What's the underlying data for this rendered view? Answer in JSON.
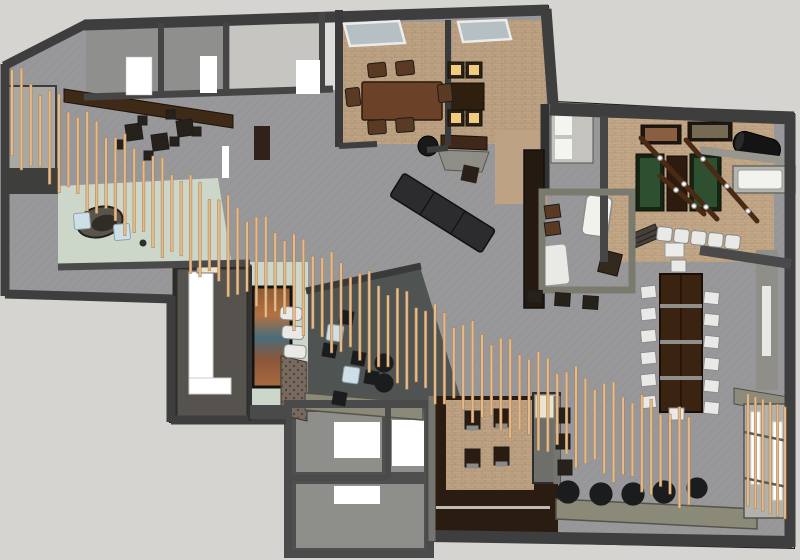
{
  "palette": {
    "outside": "#d5d4d0",
    "outline": "#1c1c1c",
    "wallDark": "#3e3e3e",
    "wallMid": "#4f4f4f",
    "wallLight": "#77766f",
    "wallOlive": "#7b7a6e",
    "carpetGray": "#98989a",
    "carpetPattern": "#888890",
    "carpetDark": "#4f5452",
    "roomGray": "#8f8f8d",
    "floorLight": "#c6c5c1",
    "tanFloor": "#bda284",
    "tanFloor2": "#c3a888",
    "brickLine": "#8a6a4a",
    "mint": "#ccd6c9",
    "woodDark": "#2a1c11",
    "woodMed": "#3f2a18",
    "woodTable": "#6b4227",
    "woodBeam": "#4a2a15",
    "slat": "#e6bb8c",
    "slatEdge": "#a97f4e",
    "green": "#2f5030",
    "glow": "#f2cb80",
    "glowFrame": "#2a2318",
    "white": "#ffffff",
    "chairWhite": "#e9e9e7",
    "chairEdge": "#8a8a88",
    "chairBrown": "#5a3a22",
    "poufBlack": "#1b1c1e",
    "furnDark": "#26211b",
    "sofaDark": "#2c2c2e",
    "blueGlass": "#b6bfc4",
    "blueTable": "#cfdfe7",
    "blueEdge": "#8fa3ad",
    "olive": "#8b8977",
    "cream": "#ece4cc",
    "stone": "#786a5e",
    "radiator": "#b4b3ac",
    "muralOrange": "#b5713f",
    "muralBlue": "#4a6d7c"
  },
  "scene": {
    "slat_screen": {
      "x_start": 12,
      "x_end": 698,
      "spacing": 9.4,
      "width": 2.6,
      "curve": {
        "x0": 20,
        "y0": 118,
        "k1": 0.66,
        "k2": 0.00022
      },
      "base_len": 86,
      "len_var": 16
    },
    "window_screen": {
      "x_start": 748,
      "x_end": 792,
      "spacing": 7.4,
      "y0": 394,
      "slope": 0.35,
      "len": 112,
      "width": 2.4
    },
    "repeats": {
      "bottom-poufs": {
        "shape": "circle",
        "fill": "poufBlack",
        "stroke": "outline",
        "r": 11,
        "items": [
          [
            568,
            492
          ],
          [
            601,
            494
          ],
          [
            633,
            494
          ],
          [
            664,
            492
          ],
          [
            697,
            488,
            10
          ]
        ]
      },
      "feature-poufs": {
        "shape": "circle",
        "fill": "poufBlack",
        "stroke": "outline",
        "r": 9,
        "items": [
          [
            384,
            363
          ],
          [
            384,
            383
          ]
        ]
      },
      "lounge-tables": {
        "shape": "rect",
        "fill": "furnDark",
        "stroke": "outline",
        "w": 16,
        "h": 16,
        "items": [
          [
            126,
            124,
            -8
          ],
          [
            152,
            134,
            -8
          ],
          [
            177,
            120,
            -8
          ]
        ]
      },
      "lounge-chairs": {
        "shape": "rect",
        "fill": "furnDark",
        "stroke": "outline",
        "w": 9,
        "h": 9,
        "items": [
          [
            116,
            140
          ],
          [
            144,
            151
          ],
          [
            170,
            137
          ],
          [
            192,
            127
          ],
          [
            138,
            116
          ],
          [
            166,
            110
          ]
        ]
      },
      "feature-stools": {
        "shape": "rect",
        "fill": "poufBlack",
        "stroke": "outline",
        "w": 13,
        "h": 13,
        "items": [
          [
            340,
            311,
            10
          ],
          [
            323,
            344,
            10
          ],
          [
            352,
            352,
            10
          ],
          [
            333,
            392,
            10
          ],
          [
            365,
            371,
            10
          ]
        ]
      },
      "blue-tables": {
        "shape": "rect",
        "fill": "blueTable",
        "stroke": "blueEdge",
        "w": 16,
        "h": 16,
        "rx": 2,
        "items": [
          [
            74,
            213,
            -5
          ],
          [
            114,
            224,
            -5
          ],
          [
            327,
            325,
            8
          ],
          [
            343,
            367,
            8
          ]
        ]
      },
      "bench-seats": {
        "shape": "rect",
        "fill": "chairWhite",
        "stroke": "chairEdge",
        "w": 22,
        "h": 13,
        "rx": 4,
        "items": [
          [
            280,
            307,
            4
          ],
          [
            282,
            326,
            4
          ],
          [
            284,
            345,
            4
          ]
        ]
      },
      "glow-chairs": {
        "shape": "glow",
        "w": 16,
        "inner": 10,
        "items": [
          [
            448,
            62
          ],
          [
            466,
            62
          ],
          [
            448,
            110
          ],
          [
            466,
            110
          ]
        ]
      },
      "dining-chairs": {
        "shape": "rect",
        "fill": "chairBrown",
        "stroke": "outline",
        "w": 18,
        "h": 14,
        "rx": 2,
        "items": [
          [
            368,
            63,
            -6
          ],
          [
            396,
            61,
            -6
          ],
          [
            368,
            120,
            -4
          ],
          [
            396,
            118,
            -4
          ],
          [
            344,
            90,
            84
          ],
          [
            436,
            86,
            84
          ]
        ]
      },
      "white-stools": {
        "shape": "rect",
        "fill": "chairWhite",
        "stroke": "chairEdge",
        "w": 15,
        "h": 14,
        "rx": 3,
        "items": [
          [
            657,
            227,
            6
          ],
          [
            674,
            229,
            6
          ],
          [
            691,
            231,
            6
          ],
          [
            708,
            233,
            6
          ],
          [
            725,
            235,
            6
          ]
        ]
      },
      "communal-chairs-left": {
        "shape": "rect",
        "fill": "chairWhite",
        "stroke": "chairEdge",
        "w": 15,
        "h": 12,
        "items": [
          [
            641,
            286,
            -6
          ],
          [
            641,
            308,
            -6
          ],
          [
            641,
            330,
            -6
          ],
          [
            641,
            352,
            -6
          ],
          [
            641,
            374,
            -6
          ],
          [
            641,
            396,
            -6
          ]
        ]
      },
      "communal-chairs-right": {
        "shape": "rect",
        "fill": "chairWhite",
        "stroke": "chairEdge",
        "w": 15,
        "h": 12,
        "items": [
          [
            704,
            292,
            6
          ],
          [
            704,
            314,
            6
          ],
          [
            704,
            336,
            6
          ],
          [
            704,
            358,
            6
          ],
          [
            704,
            380,
            6
          ],
          [
            704,
            402,
            6
          ]
        ]
      },
      "communal-chairs-ends": {
        "shape": "rect",
        "fill": "chairWhite",
        "stroke": "chairEdge",
        "w": 15,
        "h": 12,
        "items": [
          [
            671,
            260
          ],
          [
            669,
            408
          ]
        ]
      },
      "corridor-chairs": {
        "shape": "rect",
        "fill": "woodDark",
        "stroke": "outline",
        "w": 15,
        "h": 18,
        "items": [
          [
            465,
            411
          ],
          [
            494,
            409
          ],
          [
            465,
            449
          ],
          [
            494,
            447
          ]
        ]
      },
      "corridor-chair-seats": {
        "shape": "rect",
        "fill": "chairEdge",
        "stroke": "chairEdge",
        "w": 11,
        "h": 4,
        "items": [
          [
            467,
            426
          ],
          [
            496,
            424
          ],
          [
            467,
            464
          ],
          [
            496,
            462
          ]
        ]
      },
      "east-chairs": {
        "shape": "rect",
        "fill": "furnDark",
        "stroke": "outline",
        "w": 14,
        "h": 15,
        "items": [
          [
            556,
            408
          ],
          [
            556,
            434
          ],
          [
            558,
            460
          ]
        ]
      },
      "office-stools": {
        "shape": "rect",
        "fill": "furnDark",
        "stroke": "outline",
        "w": 15,
        "h": 13,
        "items": [
          [
            527,
            290,
            4
          ],
          [
            555,
            293,
            4
          ],
          [
            583,
            296,
            4
          ]
        ]
      },
      "office-chairs": {
        "shape": "rect",
        "fill": "chairBrown",
        "stroke": "outline",
        "w": 15,
        "h": 13,
        "items": [
          [
            545,
            205,
            -8
          ],
          [
            545,
            222,
            -8
          ]
        ]
      },
      "light-beams": {
        "shape": "line",
        "stroke": "woodBeam",
        "sw": 5,
        "items": [
          [
            641,
            138,
            717,
            219
          ],
          [
            686,
            140,
            757,
            221
          ],
          [
            660,
            176,
            704,
            214
          ]
        ]
      },
      "beam-bulbs": {
        "shape": "circle",
        "fill": "white",
        "stroke": "chairEdge",
        "r": 2.4,
        "items": [
          [
            660,
            158
          ],
          [
            684,
            184
          ],
          [
            706,
            207
          ],
          [
            703,
            159
          ],
          [
            727,
            186
          ],
          [
            748,
            211
          ],
          [
            676,
            190
          ],
          [
            694,
            206
          ]
        ]
      }
    }
  }
}
